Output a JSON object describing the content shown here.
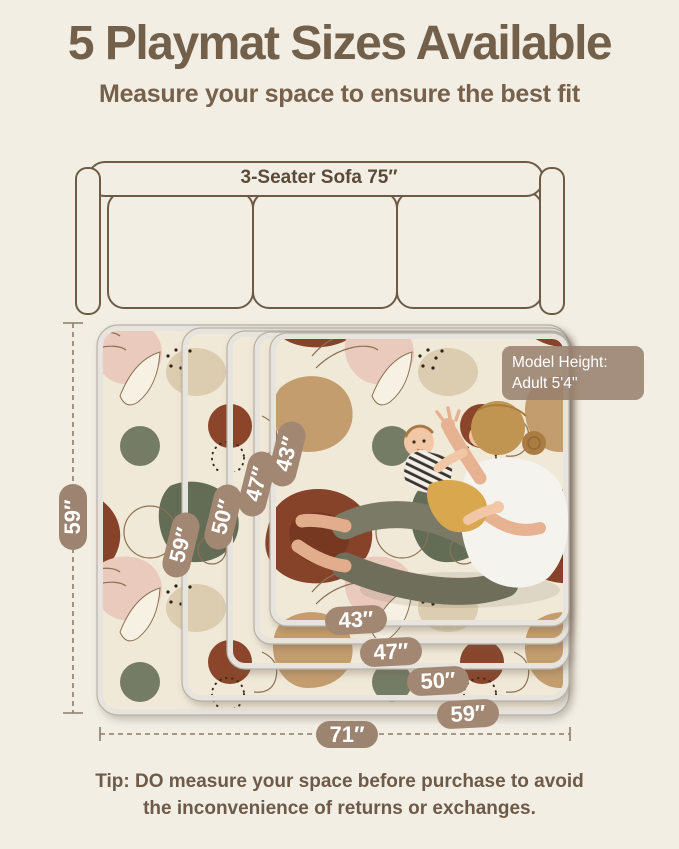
{
  "header": {
    "title": "5 Playmat Sizes Available",
    "subtitle": "Measure your space to ensure the best fit"
  },
  "sofa": {
    "label": "3-Seater Sofa 75″"
  },
  "playmat": {
    "size_labels_left": [
      "43″",
      "47″",
      "50″",
      "59″"
    ],
    "size_labels_bottom": [
      "43″",
      "47″",
      "50″",
      "59″"
    ],
    "model_badge": {
      "line1": "Model Height:",
      "line2": "Adult  5'4''"
    }
  },
  "dimensions": {
    "height_label": "59″",
    "width_label": "71″"
  },
  "tip": {
    "line1": "Tip: DO measure your space before purchase to avoid",
    "line2": "the inconvenience of returns or exchanges."
  },
  "colors": {
    "background": "#f2eee4",
    "title_brown": "#73604a",
    "badge_tan": "#a28772",
    "dimension_badge_tan": "#9d8471",
    "sofa_outline": "#6e5a45",
    "mat_rust": "#87422a",
    "mat_sage": "#646c55",
    "mat_tan": "#c49d6e",
    "mat_pink": "#e9cabd",
    "mat_cream": "#f1e9d8"
  }
}
